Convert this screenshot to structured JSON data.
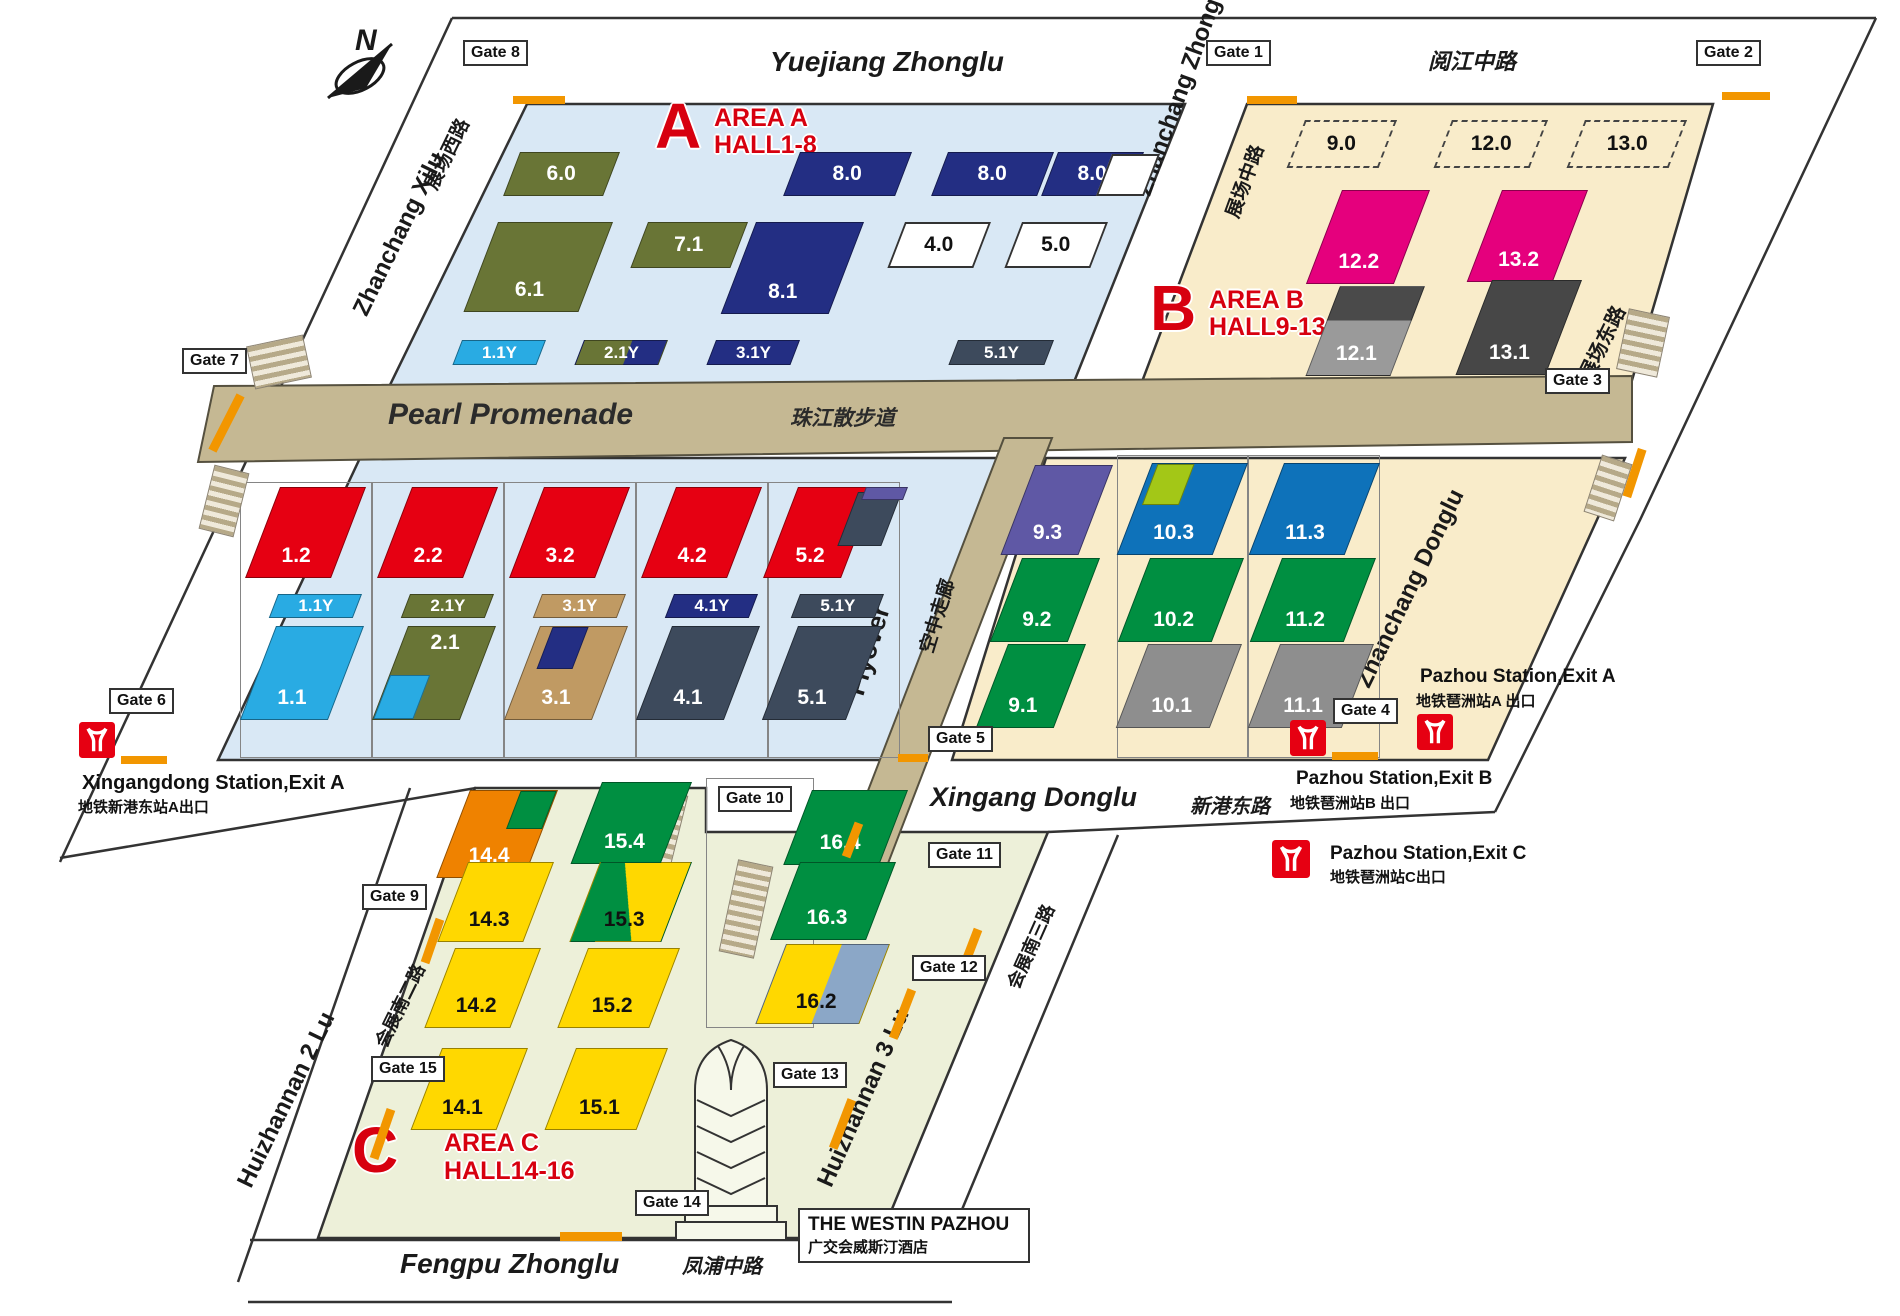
{
  "compass": {
    "north": "N"
  },
  "areas": {
    "a": {
      "letter": "A",
      "line1": "AREA A",
      "line2": "HALL1-8"
    },
    "b": {
      "letter": "B",
      "line1": "AREA B",
      "line2": "HALL9-13"
    },
    "c": {
      "letter": "C",
      "line1": "AREA C",
      "line2": "HALL14-16"
    }
  },
  "roads": {
    "yuejiang_en": "Yuejiang Zhonglu",
    "yuejiang_zh": "阅江中路",
    "zhanchang_xilu_en": "Zhanchang Xilu",
    "zhanchang_xilu_zh": "展场西路",
    "zhanchang_zhonglu_en": "Zhanchang Zhonglu",
    "zhanchang_zhonglu_zh": "展场中路",
    "zhanchang_donglu_en": "Zhanchang Donglu",
    "zhanchang_dong_zh": "展场东路",
    "xingang_en": "Xingang Donglu",
    "xingang_zh": "新港东路",
    "huizhannan2_en": "Huizhannan 2 Lu",
    "huizhannan2_zh": "会展南二路",
    "huizhannan3_en": "Huizhannan 3 Lu",
    "huizhannan3_zh": "会展南三路",
    "fengpu_en": "Fengpu Zhonglu",
    "fengpu_zh": "凤浦中路"
  },
  "promenade": {
    "en": "Pearl Promenade",
    "zh": "珠江散步道"
  },
  "flyover": {
    "en": "Flyover",
    "zh": "空中走廊"
  },
  "halls": {
    "h6_0": "6.0",
    "h7_1": "7.1",
    "h6_1": "6.1",
    "h8_0": "8.0",
    "h8_1": "8.1",
    "h4_0": "4.0",
    "h5_0": "5.0",
    "h1_1y": "1.1Y",
    "h2_1y": "2.1Y",
    "h3_1y": "3.1Y",
    "h4_1y": "4.1Y",
    "h5_1y": "5.1Y",
    "h1_2": "1.2",
    "h2_2": "2.2",
    "h3_2": "3.2",
    "h4_2": "4.2",
    "h5_2": "5.2",
    "h1_1": "1.1",
    "h2_1": "2.1",
    "h3_1": "3.1",
    "h4_1": "4.1",
    "h5_1": "5.1",
    "h9_0": "9.0",
    "h12_0": "12.0",
    "h13_0": "13.0",
    "h12_2": "12.2",
    "h13_2": "13.2",
    "h12_1": "12.1",
    "h13_1": "13.1",
    "h9_3": "9.3",
    "h10_3": "10.3",
    "h11_3": "11.3",
    "h9_2": "9.2",
    "h10_2": "10.2",
    "h11_2": "11.2",
    "h9_1": "9.1",
    "h10_1": "10.1",
    "h11_1": "11.1",
    "h14_4": "14.4",
    "h15_4": "15.4",
    "h16_4": "16.4",
    "h14_3": "14.3",
    "h15_3": "15.3",
    "h16_3": "16.3",
    "h14_2": "14.2",
    "h15_2": "15.2",
    "h16_2": "16.2",
    "h14_1": "14.1",
    "h15_1": "15.1"
  },
  "gates": {
    "g1": "Gate 1",
    "g2": "Gate 2",
    "g3": "Gate 3",
    "g4": "Gate 4",
    "g5": "Gate 5",
    "g6": "Gate 6",
    "g7": "Gate 7",
    "g8": "Gate 8",
    "g9": "Gate 9",
    "g10": "Gate 10",
    "g11": "Gate 11",
    "g12": "Gate 12",
    "g13": "Gate 13",
    "g14": "Gate 14",
    "g15": "Gate 15"
  },
  "stations": {
    "xingangdong": {
      "en": "Xingangdong Station,Exit A",
      "zh": "地铁新港东站A出口"
    },
    "pazhou_a": {
      "en": "Pazhou Station,Exit A",
      "zh": "地铁琶洲站A 出口"
    },
    "pazhou_b": {
      "en": "Pazhou Station,Exit B",
      "zh": "地铁琶洲站B 出口"
    },
    "pazhou_c": {
      "en": "Pazhou Station,Exit C",
      "zh": "地铁琶洲站C出口"
    }
  },
  "hotel": {
    "en": "THE WESTIN PAZHOU",
    "zh": "广交会威斯汀酒店"
  },
  "palette": {
    "area_a_bg": "#d9e8f5",
    "area_b_bg": "#f9ecca",
    "area_c_bg": "#edf0d9",
    "promenade": "#c5b893",
    "gate_marker": "#f29600",
    "area_label_red": "#d7000f",
    "hall_olive": "#697536",
    "hall_navy": "#232e83",
    "hall_cyan": "#29abe3",
    "hall_red": "#e60012",
    "hall_magenta": "#e5007d",
    "hall_slate": "#3d4a5c",
    "hall_tan": "#c09a63",
    "hall_purple": "#5f58a5",
    "hall_blue": "#0e72ba",
    "hall_green": "#008f41",
    "hall_gray": "#9a9a9a",
    "hall_darkgray": "#474747",
    "hall_orange": "#ef8200",
    "hall_yellow": "#ffd800",
    "hall_yellowgreen": "#a3c717",
    "hall_bluegray": "#8ba7c7",
    "metro_red": "#e60012"
  }
}
